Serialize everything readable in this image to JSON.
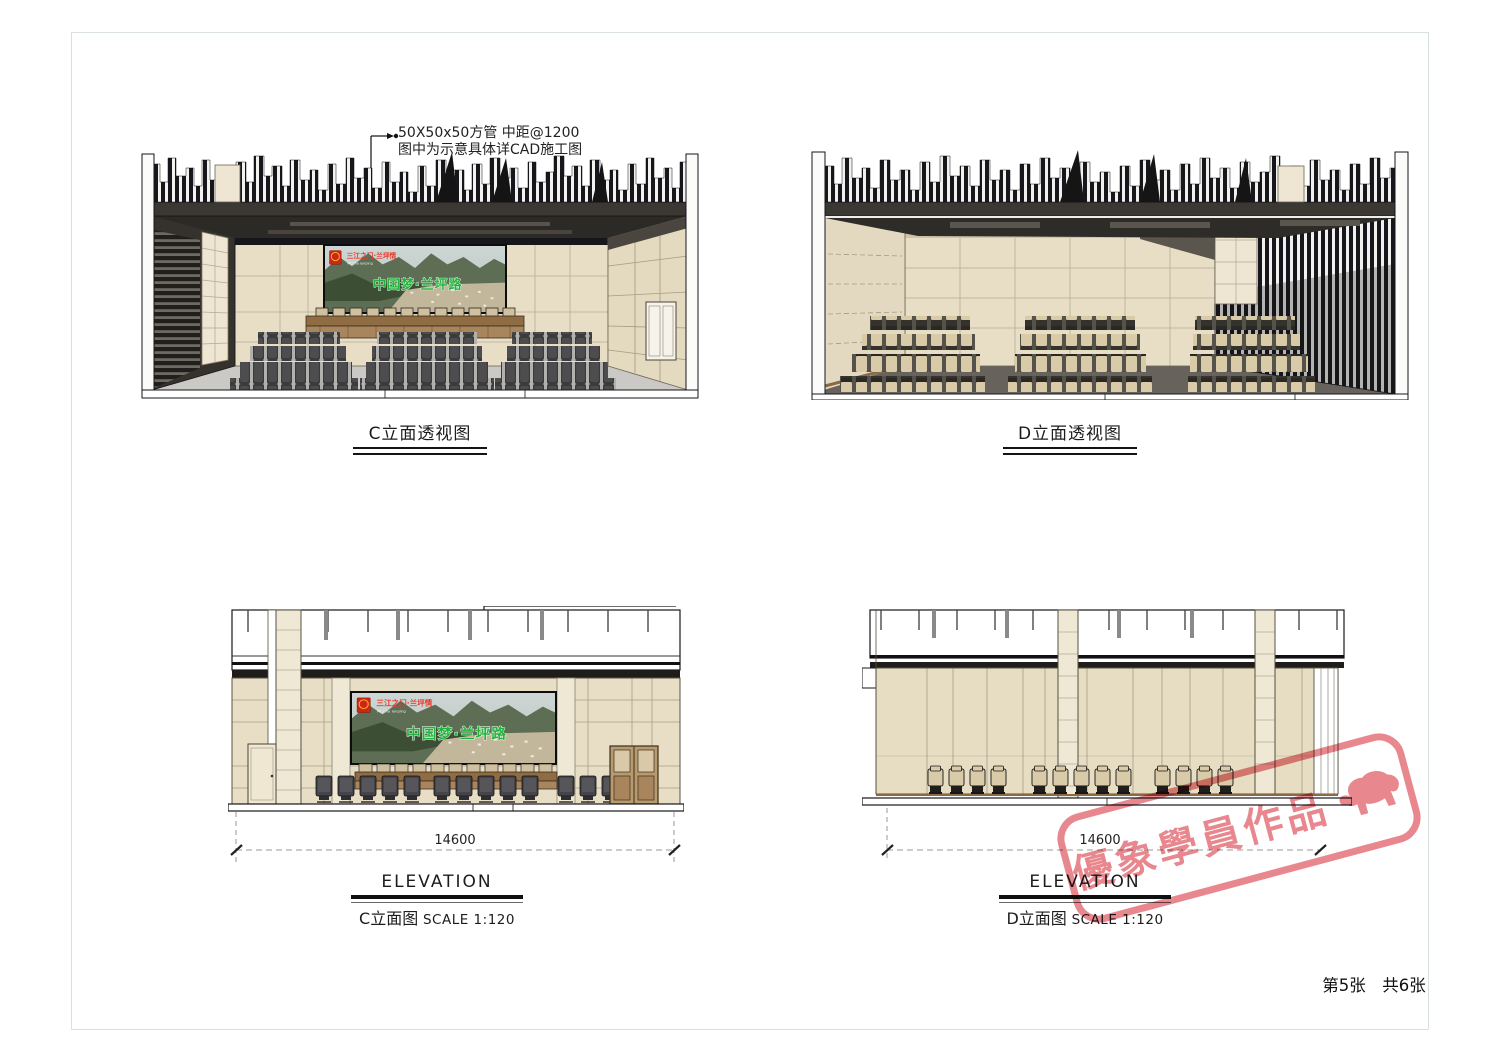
{
  "sheet": {
    "page_info": "第5张　共6张",
    "annotation_line1": "50X50x50方管 中距@1200",
    "annotation_line2": "图中为示意具体详CAD施工图"
  },
  "views": {
    "c_perspective": {
      "label": "C立面透视图"
    },
    "d_perspective": {
      "label": "D立面透视图"
    },
    "c_elevation": {
      "name": "ELEVATION",
      "label": "C立面图",
      "scale": "SCALE 1:120",
      "width_dimension": "14600"
    },
    "d_elevation": {
      "name": "ELEVATION",
      "label": "D立面图",
      "scale": "SCALE 1:120",
      "width_dimension": "14600"
    }
  },
  "screen_banner": {
    "emblem_icon": "national-emblem",
    "top_title": "三江之门·兰坪情",
    "top_subtitle": "Mt.Cha lanping",
    "main_slogan": "中国梦·兰坪路"
  },
  "stamp": {
    "text": "優象學員作品",
    "icon": "elephant",
    "color": "#e5767e"
  },
  "colors": {
    "stone_beige": "#e8dec6",
    "cream_stone": "#efe8d4",
    "ceiling_dark": "#3b3834",
    "seat_dark": "#45454a",
    "seat_beige": "#d9cba8",
    "wood_rostrum": "#8f6c42",
    "slogan_green": "#23b23c",
    "banner_red": "#e8392a",
    "stamp_pink": "#e5767e",
    "dimension_gray": "#9a9a9a"
  }
}
